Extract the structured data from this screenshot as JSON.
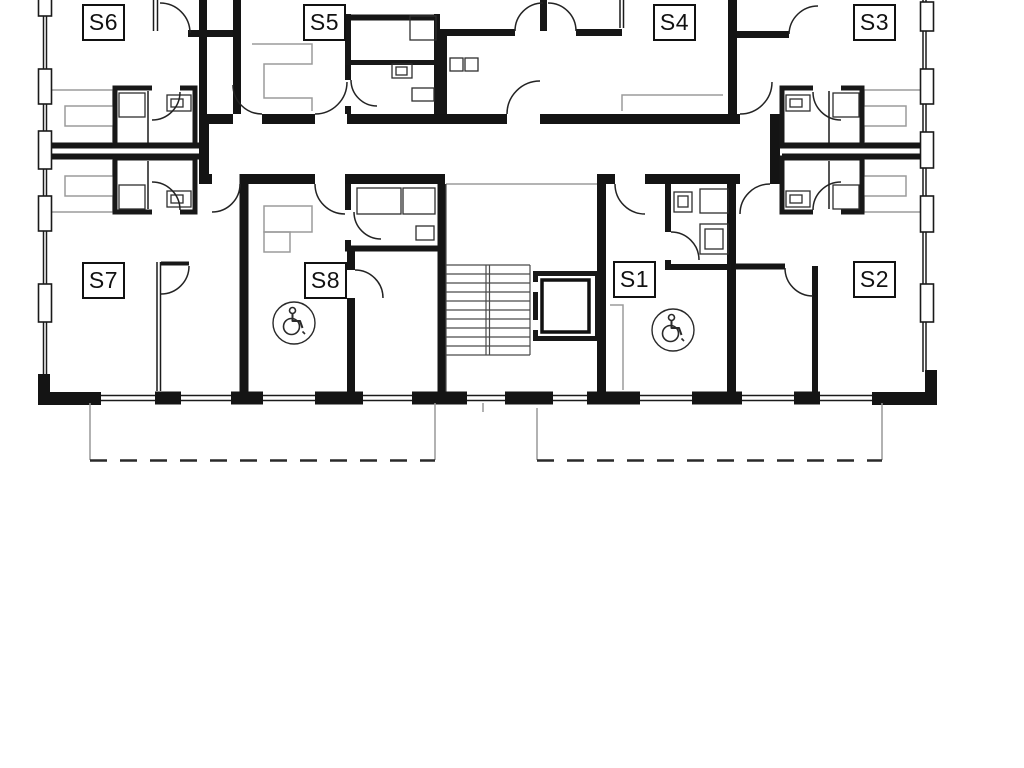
{
  "plan": {
    "units": [
      {
        "label": "S1",
        "accessible": true
      },
      {
        "label": "S2",
        "accessible": false
      },
      {
        "label": "S3",
        "accessible": false
      },
      {
        "label": "S4",
        "accessible": false
      },
      {
        "label": "S5",
        "accessible": false
      },
      {
        "label": "S6",
        "accessible": false
      },
      {
        "label": "S7",
        "accessible": false
      },
      {
        "label": "S8",
        "accessible": true
      }
    ],
    "colors": {
      "wall": "#141414",
      "background": "#ffffff",
      "light_outline": "#9b9b9b"
    }
  }
}
